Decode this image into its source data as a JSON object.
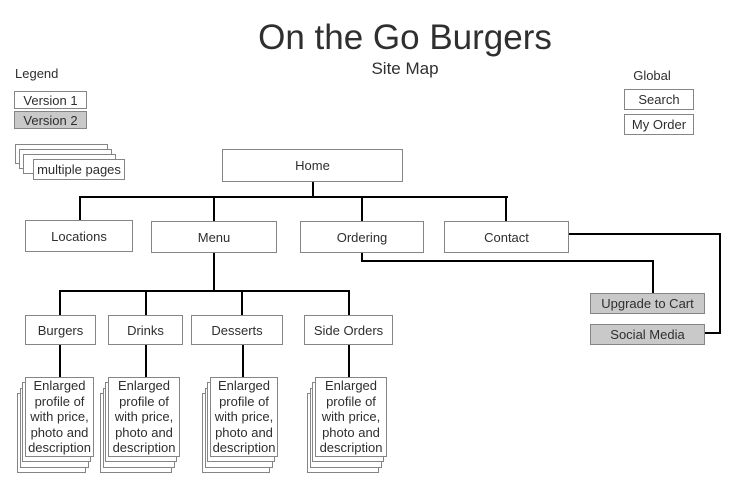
{
  "title": "On the Go Burgers",
  "subtitle": "Site Map",
  "legend": {
    "label": "Legend",
    "version1": "Version 1",
    "version2": "Version 2",
    "multiple_pages": "multiple pages"
  },
  "global_nav": {
    "label": "Global",
    "items": [
      "Search",
      "My Order"
    ]
  },
  "nodes": {
    "home": "Home",
    "locations": "Locations",
    "menu": "Menu",
    "ordering": "Ordering",
    "contact": "Contact",
    "burgers": "Burgers",
    "drinks": "Drinks",
    "desserts": "Desserts",
    "side_orders": "Side Orders",
    "upgrade_to_cart": "Upgrade to Cart",
    "social_media": "Social Media"
  },
  "page_stack": {
    "lines": [
      "Enlarged",
      "profile of",
      "with price,",
      "photo and",
      "description"
    ]
  },
  "colors": {
    "box_border": "#858585",
    "connector": "#000000",
    "gray_fill": "#c9c9c9",
    "text": "#2e2e2e"
  }
}
